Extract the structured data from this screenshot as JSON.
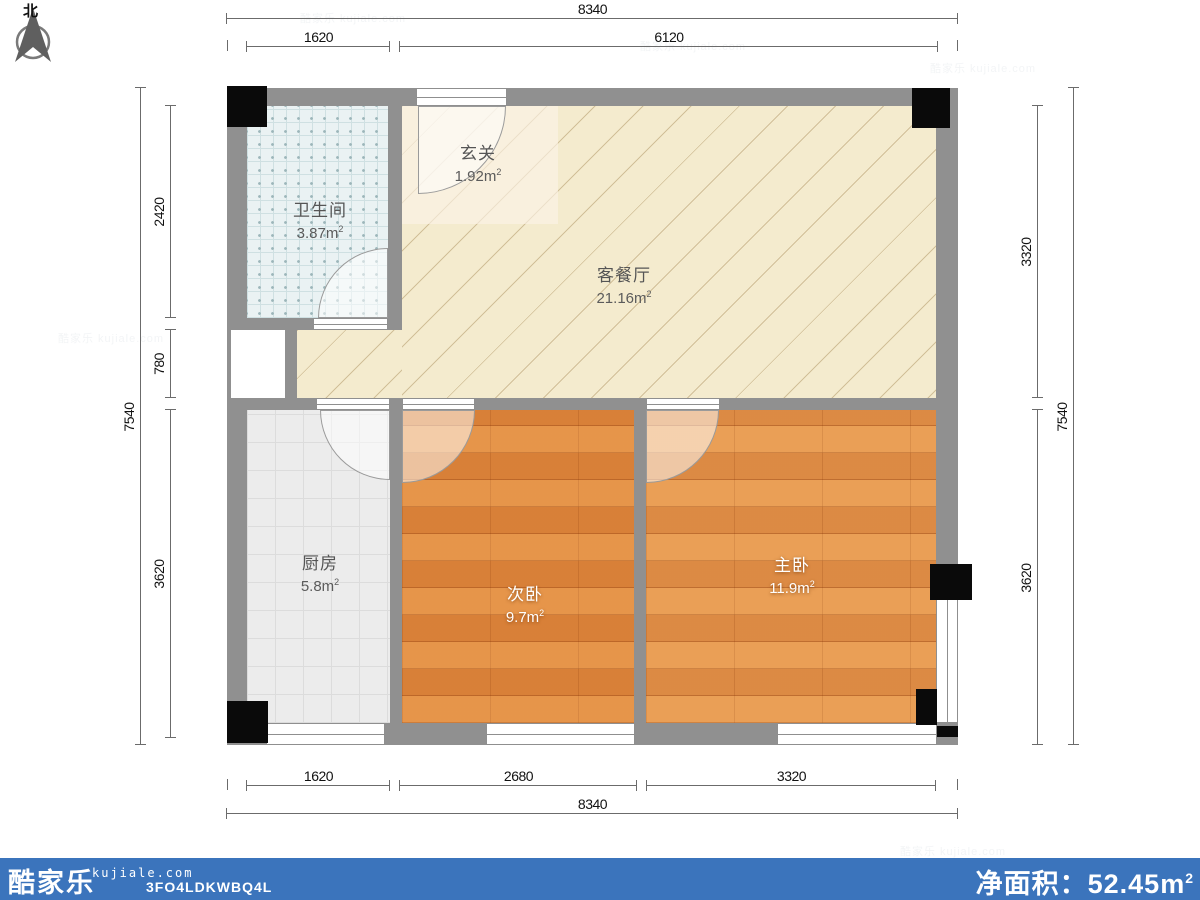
{
  "north": {
    "label": "北"
  },
  "watermark": {
    "text": "酷家乐 kujiale.com"
  },
  "rooms": {
    "hallway": {
      "name": "玄关",
      "area": "1.92"
    },
    "bathroom": {
      "name": "卫生间",
      "area": "3.87"
    },
    "living": {
      "name": "客餐厅",
      "area": "21.16"
    },
    "kitchen": {
      "name": "厨房",
      "area": "5.8"
    },
    "bedroom_second": {
      "name": "次卧",
      "area": "9.7"
    },
    "bedroom_master": {
      "name": "主卧",
      "area": "11.9"
    }
  },
  "units": {
    "m": "m",
    "exp": "2"
  },
  "dims": {
    "top_total": [
      "8340"
    ],
    "top_sub": [
      "1620",
      "6120"
    ],
    "bottom_sub": [
      "1620",
      "2680",
      "3320"
    ],
    "bottom_total": [
      "8340"
    ],
    "left_total": [
      "7540"
    ],
    "left_sub": [
      "2420",
      "780",
      "3620"
    ],
    "right_sub": [
      "3320",
      "3620"
    ],
    "right_total": [
      "7540"
    ]
  },
  "footer": {
    "logo": "酷家乐",
    "domain": "kujiale.com",
    "code": "3FO4LDKWBQ4L",
    "net_area_label": "净面积：",
    "net_area_value": "52.45"
  },
  "colors": {
    "wall": "#909090",
    "column": "#0a0a0a",
    "living_floor": "#f4ebce",
    "wood_floor": "#e1893e",
    "bath_floor": "#eaf2f3",
    "kitchen_floor": "#ececec",
    "footer_bar": "#3b74bc",
    "dim_line": "#6b6b6b"
  }
}
